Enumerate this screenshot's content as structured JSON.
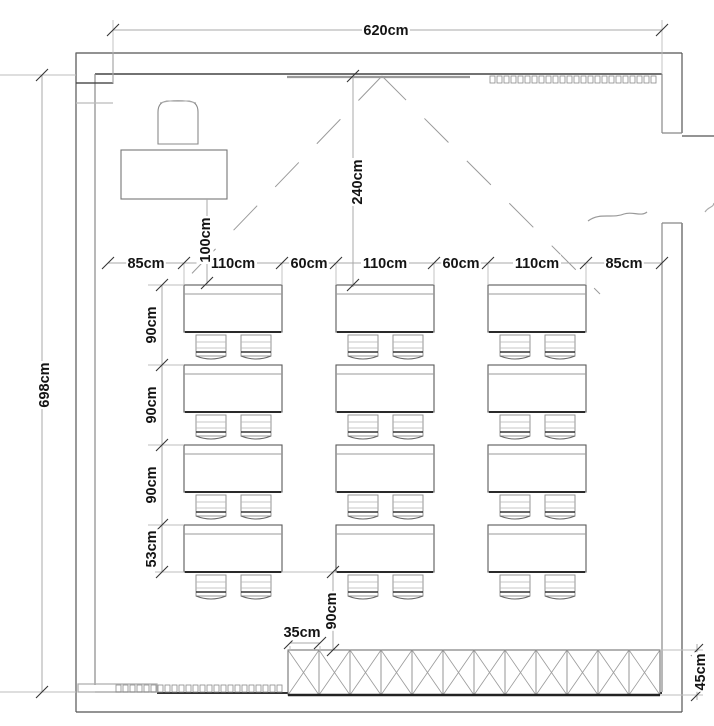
{
  "drawing": {
    "type": "classroom-floor-plan"
  },
  "dims": {
    "width_total": "620cm",
    "height_total": "698cm",
    "column_row": [
      "85cm",
      "110cm",
      "60cm",
      "110cm",
      "60cm",
      "110cm",
      "85cm"
    ],
    "teacher_gap": "100cm",
    "board_distance": "240cm",
    "row_spacing": [
      "90cm",
      "90cm",
      "90cm",
      "53cm"
    ],
    "cabinet_offset": "35cm",
    "back_gap": "90cm",
    "cabinet_depth": "45cm"
  },
  "plan": {
    "desk_columns_x": [
      184,
      336,
      488
    ],
    "desk_rows_y": [
      285,
      365,
      445,
      525
    ],
    "desk_w": 98,
    "desk_h": 47,
    "chair_offsets": [
      12,
      57
    ],
    "chair_w": 30,
    "cabinet": {
      "x": 288,
      "y": 650,
      "w": 372,
      "h": 45,
      "cells": 12
    },
    "radiators": [
      {
        "x": 490,
        "y": 76,
        "count": 24
      },
      {
        "x": 116,
        "y": 685,
        "count": 24
      }
    ],
    "sight_apex": [
      382,
      76
    ],
    "sight_left_end": [
      176,
      290
    ],
    "sight_right_end": [
      600,
      294
    ]
  },
  "colors": {
    "wall_dark": "#3c3c3c",
    "wall_mid": "#6e6e6e",
    "wall_light": "#999999",
    "dim_line": "#a8a8a8",
    "ext_line": "#bdbdbd",
    "tick": "#333333",
    "furniture_edge": "#2a2a2a",
    "text": "#141414",
    "bg": "#ffffff"
  }
}
